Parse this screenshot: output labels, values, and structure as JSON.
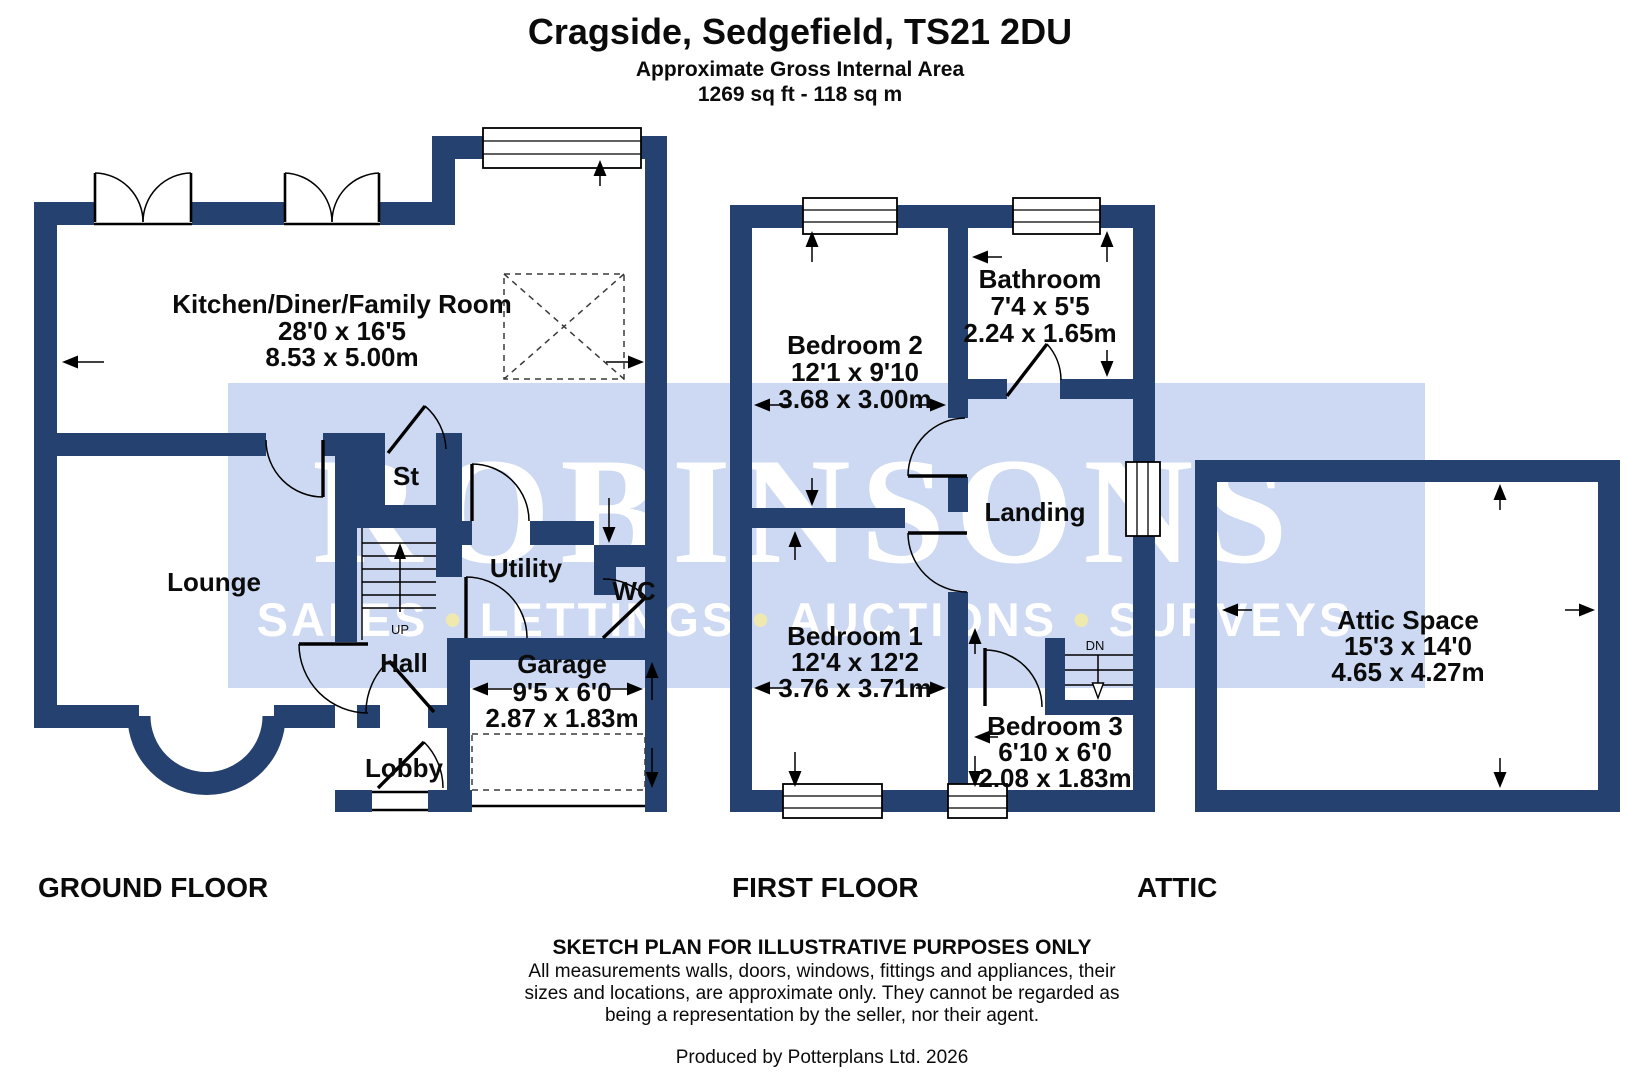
{
  "header": {
    "title": "Cragside, Sedgefield, TS21 2DU",
    "subtitle": "Approximate Gross Internal Area",
    "area": "1269 sq ft -  118 sq m"
  },
  "watermark": {
    "brand": "ROBINSONS",
    "word1": "SALES",
    "word2": "LETTINGS",
    "word3": "AUCTIONS",
    "word4": "SURVEYS",
    "bullet": "•"
  },
  "ground_floor": {
    "label": "GROUND FLOOR",
    "stairs_direction": "UP",
    "rooms": {
      "kitchen": {
        "name": "Kitchen/Diner/Family Room",
        "imperial": "28'0 x 16'5",
        "metric": "8.53 x 5.00m"
      },
      "lounge": {
        "name": "Lounge"
      },
      "store": {
        "name": "St"
      },
      "utility": {
        "name": "Utility"
      },
      "wc": {
        "name": "WC"
      },
      "hall": {
        "name": "Hall"
      },
      "lobby": {
        "name": "Lobby"
      },
      "garage": {
        "name": "Garage",
        "imperial": "9'5 x 6'0",
        "metric": "2.87 x 1.83m"
      }
    }
  },
  "first_floor": {
    "label": "FIRST FLOOR",
    "stairs_direction": "DN",
    "rooms": {
      "bedroom2": {
        "name": "Bedroom 2",
        "imperial": "12'1 x 9'10",
        "metric": "3.68 x 3.00m"
      },
      "bathroom": {
        "name": "Bathroom",
        "imperial": "7'4 x 5'5",
        "metric": "2.24 x 1.65m"
      },
      "landing": {
        "name": "Landing"
      },
      "bedroom1": {
        "name": "Bedroom 1",
        "imperial": "12'4 x 12'2",
        "metric": "3.76 x 3.71m"
      },
      "bedroom3": {
        "name": "Bedroom 3",
        "imperial": "6'10 x 6'0",
        "metric": "2.08 x 1.83m"
      }
    }
  },
  "attic": {
    "label": "ATTIC",
    "rooms": {
      "attic_space": {
        "name": "Attic Space",
        "imperial": "15'3 x 14'0",
        "metric": "4.65 x 4.27m"
      }
    }
  },
  "footer": {
    "sketch": "SKETCH PLAN FOR ILLUSTRATIVE PURPOSES ONLY",
    "disclaimer1": "All measurements walls, doors, windows, fittings and appliances, their",
    "disclaimer2": "sizes and locations, are approximate only. They cannot be regarded as",
    "disclaimer3": "being a representation by the seller, nor their agent.",
    "produced": "Produced by Potterplans Ltd. 2026"
  }
}
